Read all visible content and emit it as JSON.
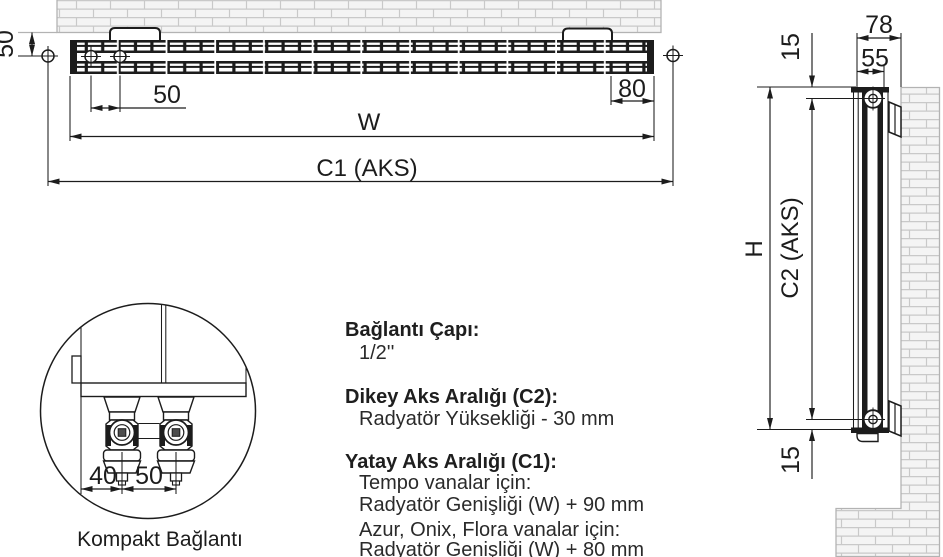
{
  "drawing": {
    "title_hint": "radiator installation dimensions drawing",
    "top_view": {
      "wall_offset": "50",
      "hole_spacing": "50",
      "bracket_end_offset": "80",
      "width_label": "W",
      "axis_label": "C1 (AKS)"
    },
    "side_view": {
      "total_depth": "78",
      "panel_depth": "55",
      "top_pipe_offset": "15",
      "height_label": "H",
      "axis_label": "C2 (AKS)",
      "bottom_pipe_offset": "15"
    },
    "detail_view": {
      "edge_to_valve": "40",
      "valve_spacing": "50",
      "caption": "Kompakt Bağlantı"
    },
    "specs": [
      {
        "title": "Bağlantı Çapı:",
        "lines": [
          "1/2''"
        ]
      },
      {
        "title": "Dikey Aks Aralığı (C2):",
        "lines": [
          "Radyatör Yüksekliği - 30 mm"
        ]
      },
      {
        "title": "Yatay Aks Aralığı (C1):",
        "lines": [
          "Tempo vanalar için:",
          "Radyatör Genişliği (W) + 90 mm",
          "Azur, Onix, Flora vanalar için:",
          "Radyatör Genişliği (W) + 80 mm"
        ]
      }
    ]
  },
  "colors": {
    "ink": "#1c1c1c",
    "wall_outline": "#b3b3b3",
    "wall_fill": "#f4f4f4",
    "brick_joint": "#c9c9c9",
    "valve_socket": "#4d4d4d"
  }
}
